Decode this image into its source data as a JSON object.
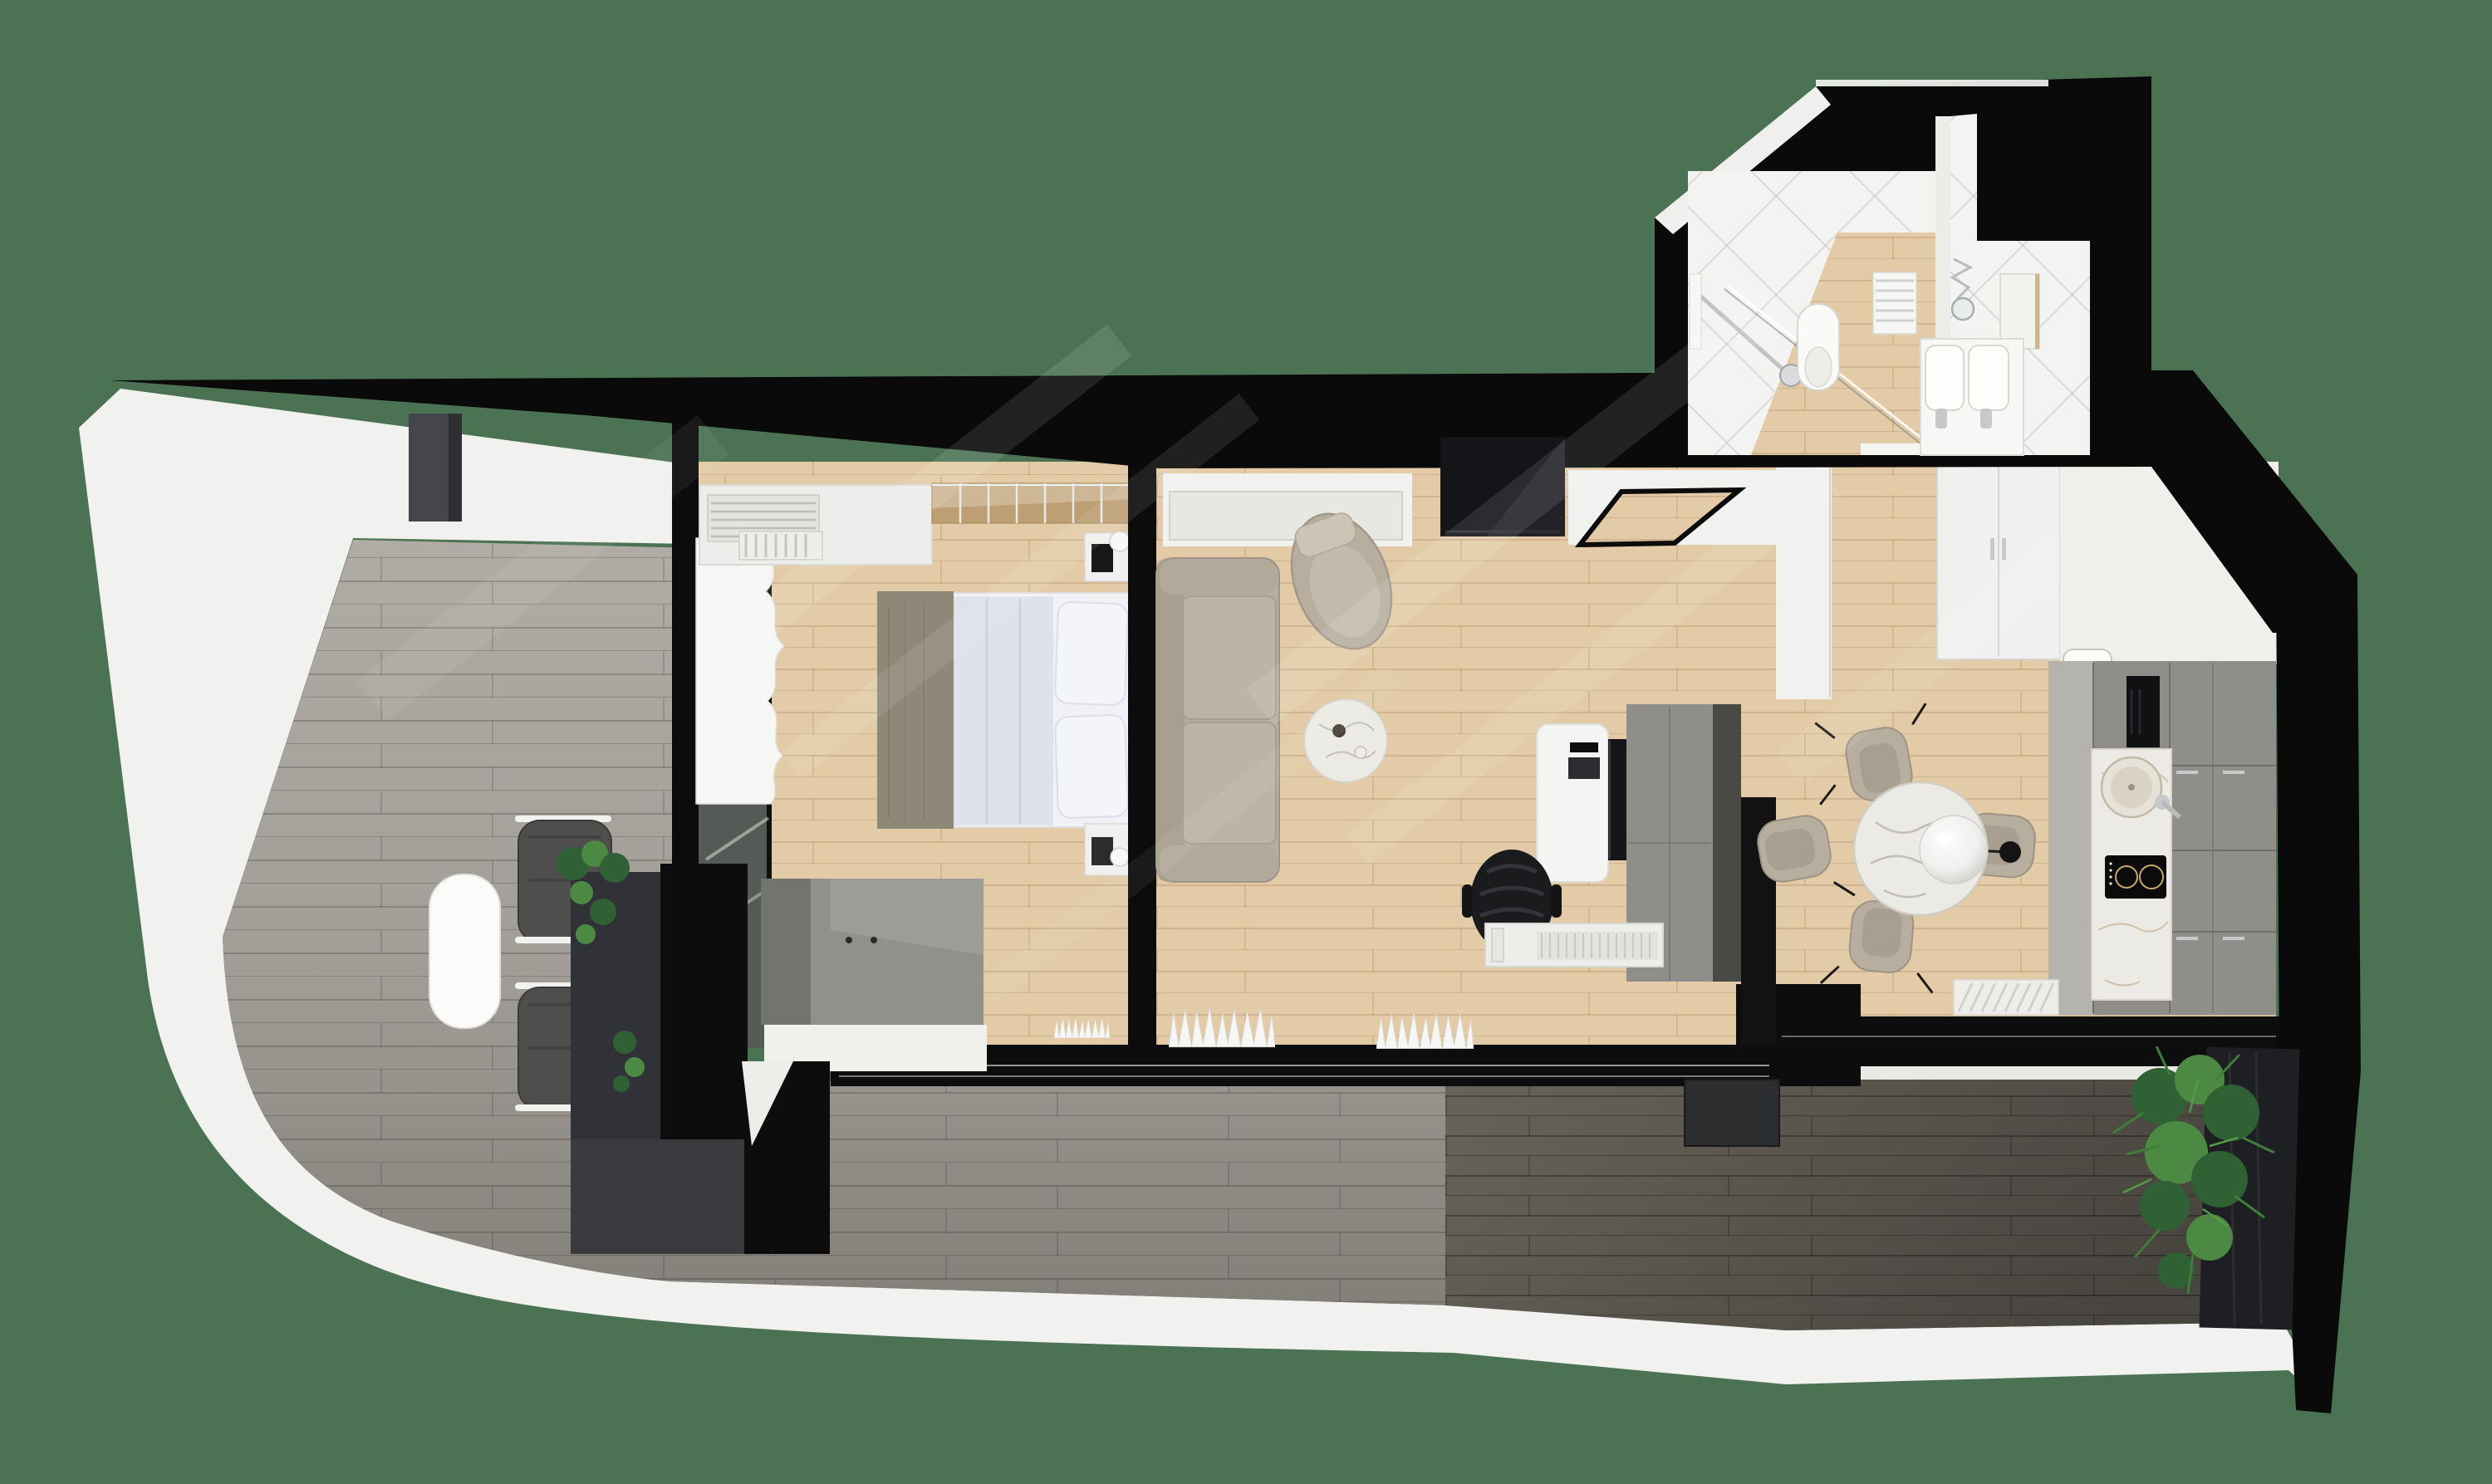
{
  "meta": {
    "scene_type": "3d-apartment-floorplan-top-down-render",
    "text_content": "none"
  },
  "palette": {
    "bg_green": "#4C7254",
    "shell_black": "#0A0A0B",
    "wall_white": "#F1F1EF",
    "wall_shadow": "#D9D9D5",
    "wood_floor": "#E2CBA6",
    "deck_grey": "#B0ACA5",
    "terrace_grey": "#6E695F",
    "glass_dark": "#555A56",
    "cabinet_grey": "#8F8E8A",
    "cabinet_dark": "#4A4945",
    "sofa_beige": "#B7AE9F",
    "sofa_edge": "#9D9486",
    "marble": "#ECEAE4",
    "bed_duvet": "#DFE2EC",
    "bed_sheet": "#F0F1F6",
    "throw_grey": "#8E8878",
    "mirror_wood": "#BE9F74",
    "chrome": "#C6C8CA",
    "plant_green": "#2F6134",
    "plant_green_light": "#4C8A44",
    "black_band": "#0D0D0E",
    "tv_black": "#141518",
    "radiator_white": "#EDEDEA",
    "curtain_white": "#F6F6F4",
    "toilet_white": "#FAFAF8",
    "tile_white": "#F3F3F2",
    "planter_dark": "#313237",
    "hob_black": "#0B0B0C"
  },
  "rooms": {
    "balcony": {
      "items": [
        "grey-plank-deck",
        "outdoor-table",
        "outdoor-chair",
        "outdoor-chair",
        "planter-plants",
        "privacy-wall",
        "ac-unit"
      ]
    },
    "bedroom": {
      "items": [
        "wardrobe-with-ac-grille",
        "mirror-sliding-closet",
        "double-bed",
        "grey-throw",
        "pillows",
        "nightstand-top",
        "nightstand-bottom",
        "dresser",
        "window-curtain",
        "radiator"
      ]
    },
    "living": {
      "items": [
        "sofa",
        "armchair",
        "marble-coffee-table",
        "wall-tv",
        "media-console",
        "entry-mat",
        "desk",
        "monitor",
        "keyboard",
        "office-chair",
        "storage-unit",
        "radiator",
        "window-curtains"
      ]
    },
    "dining": {
      "items": [
        "round-marble-table",
        "pendant-lamp",
        "dining-chair",
        "dining-chair",
        "dining-chair",
        "dining-chair",
        "radiator"
      ]
    },
    "kitchen": {
      "items": [
        "grey-cabinets",
        "marble-worktop",
        "round-sink",
        "faucet",
        "induction-hob",
        "cooker-hood",
        "counter-basin"
      ]
    },
    "bathroom": {
      "items": [
        "walk-in-shower",
        "glass-screen",
        "wall-hung-toilet",
        "towel-radiator",
        "double-basin-vanity",
        "round-mirror",
        "wall-cabinet"
      ]
    },
    "terrace": {
      "items": [
        "dark-plank-deck",
        "planter-box",
        "palm-plant",
        "tilted-screen-wall"
      ]
    }
  }
}
